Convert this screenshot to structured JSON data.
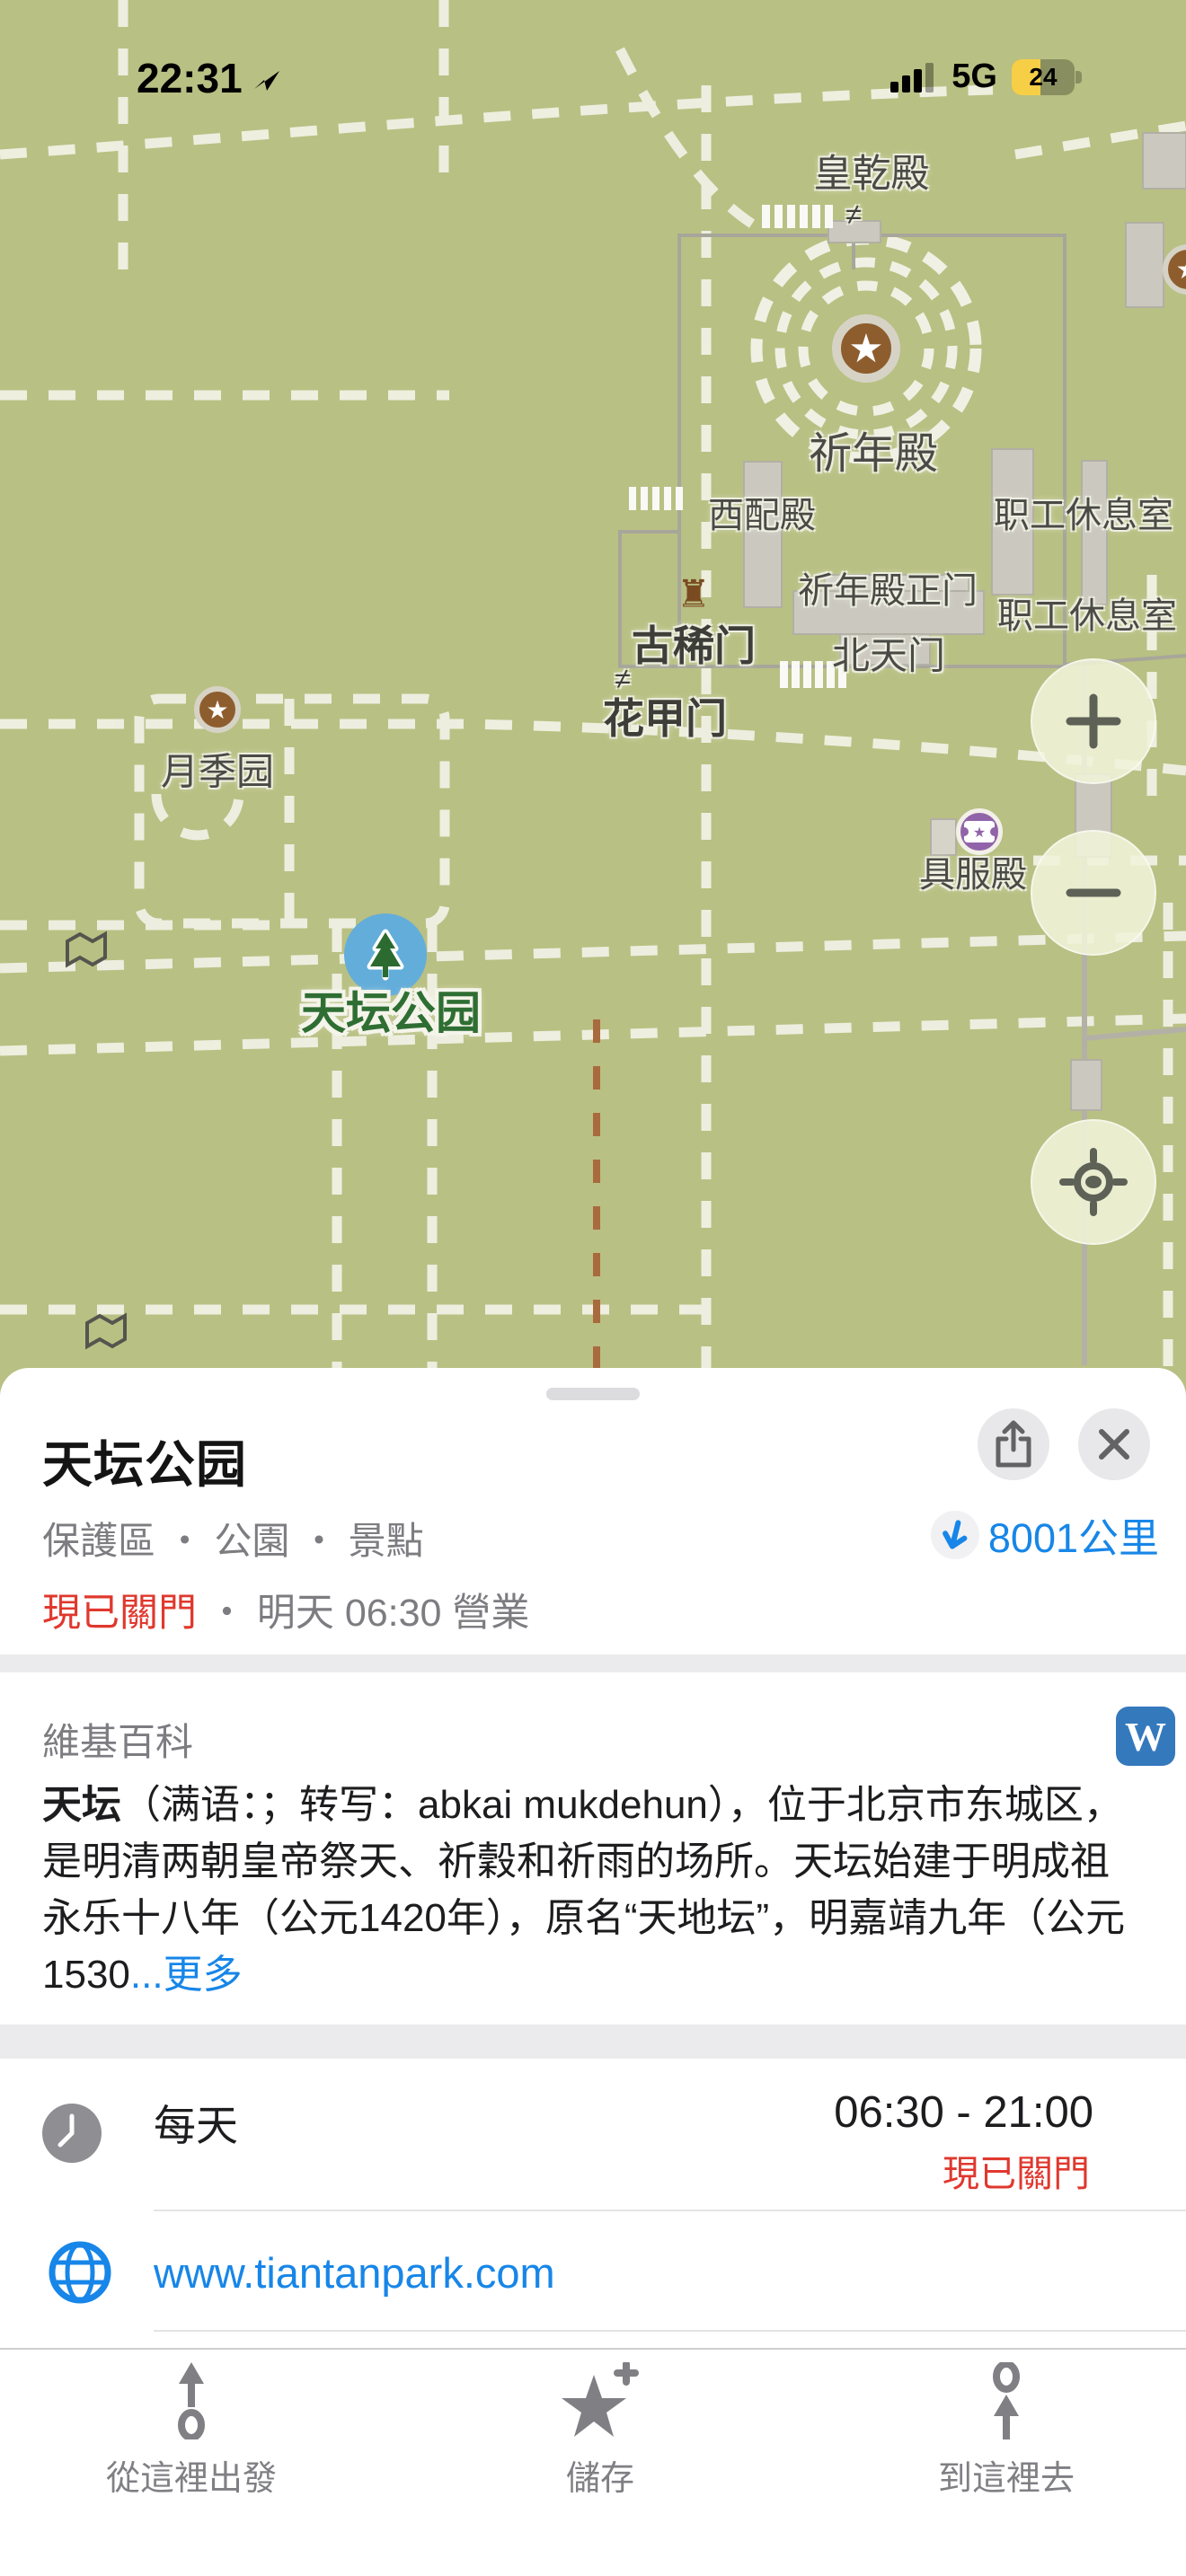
{
  "colors": {
    "map-green": "#b9c083",
    "path-white": "#f0f1e4",
    "accent-blue": "#1786e8",
    "danger-red": "#e0382e",
    "park-green": "#2f6e33",
    "poi-brown": "#8e5d2e",
    "poi-purple": "#9164a9",
    "marker-blue": "#63adda",
    "wiki-blue": "#3579bd",
    "battery-yellow": "#f6cf47"
  },
  "status_bar": {
    "time": "22:31",
    "network": "5G",
    "battery_percent": "24"
  },
  "map": {
    "labels": {
      "huang_qian_dian": "皇乾殿",
      "qi_nian_dian": "祈年殿",
      "xi_pei_dian": "西配殿",
      "zhigong_xiuxishi_1": "职工休息室",
      "qi_nian_dian_zhengmen": "祈年殿正门",
      "zhigong_xiuxishi_2": "职工休息室",
      "gu_xi_men": "古稀门",
      "bei_tian_men": "北天门",
      "hua_jia_men": "花甲门",
      "yue_ji_yuan": "月季园",
      "ju_fu_dian": "具服殿",
      "park_name": "天坛公园"
    },
    "gate_glyph": "≠",
    "tower_glyph": "♜",
    "star_glyph": "★"
  },
  "sheet": {
    "title": "天坛公园",
    "category": "保護區 ・ 公園 ・ 景點",
    "distance": "8001公里",
    "status_closed": "現已關門",
    "status_rest": " ・ 明天 06:30 營業"
  },
  "wikipedia": {
    "header": "維基百科",
    "badge": "W",
    "lead": "天坛",
    "body": "（满语：；转写：abkai mukdehun），位于北京市东城区，是明清两朝皇帝祭天、祈穀和祈雨的场所。天坛始建于明成祖永乐十八年（公元1420年），原名“天地坛”，明嘉靖九年（公元1530",
    "more": "...更多"
  },
  "hours": {
    "label": "每天",
    "time": "06:30 - 21:00",
    "status": "現已關門"
  },
  "website": {
    "url": "www.tiantanpark.com"
  },
  "toolbar": {
    "from_here": "從這裡出發",
    "save": "儲存",
    "to_here": "到這裡去"
  }
}
